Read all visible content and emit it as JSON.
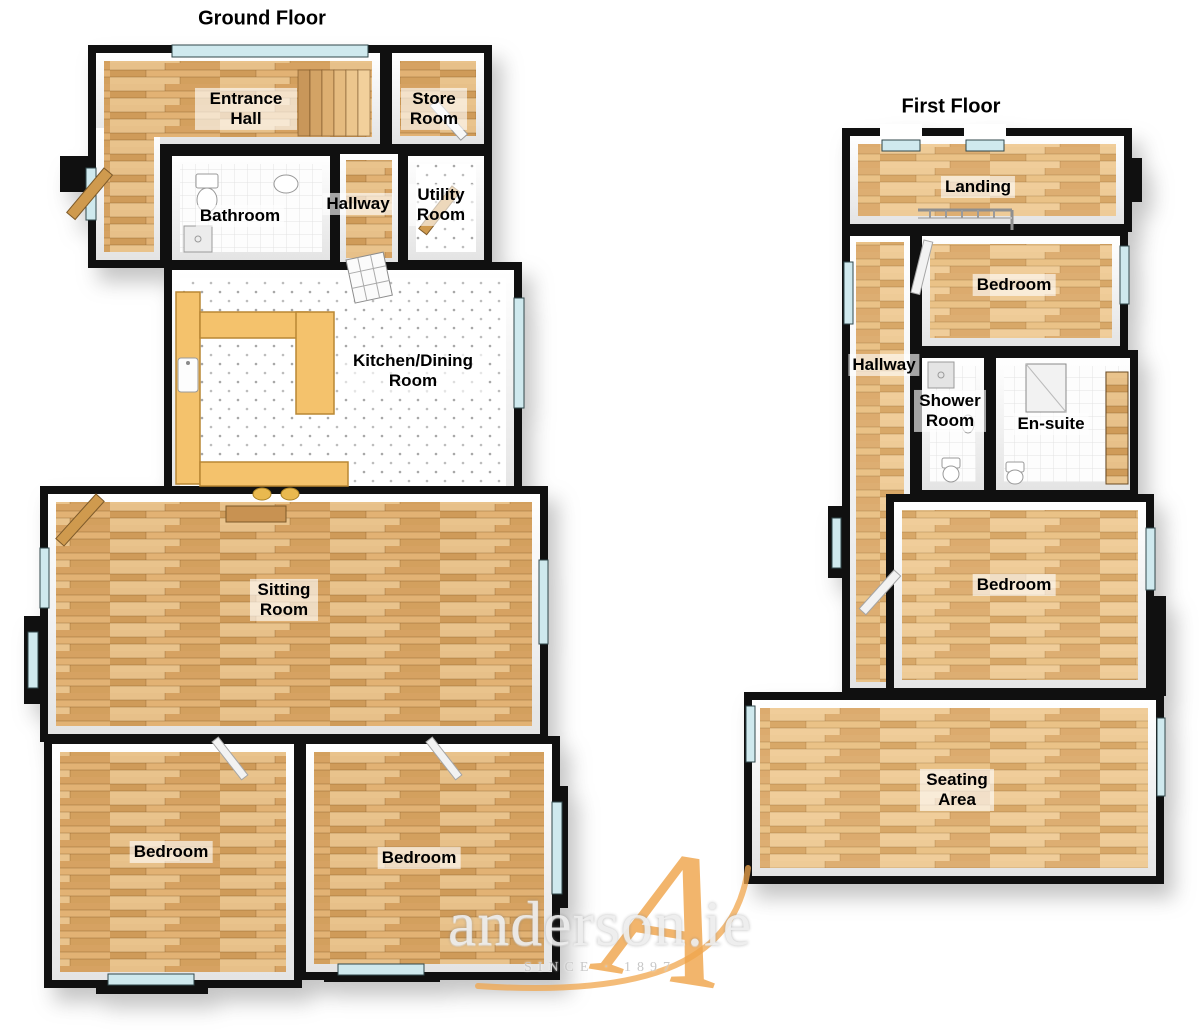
{
  "floors": {
    "ground": {
      "title": "Ground Floor",
      "rooms": {
        "entrance_hall": "Entrance Hall",
        "store_room": "Store Room",
        "bathroom": "Bathroom",
        "hallway": "Hallway",
        "utility_room": "Utility Room",
        "kitchen_dining": "Kitchen/Dining Room",
        "sitting_room": "Sitting Room",
        "bedroom_left": "Bedroom",
        "bedroom_right": "Bedroom"
      }
    },
    "first": {
      "title": "First Floor",
      "rooms": {
        "landing": "Landing",
        "hallway": "Hallway",
        "bedroom_top": "Bedroom",
        "shower_room": "Shower Room",
        "en_suite": "En-suite",
        "bedroom_middle": "Bedroom",
        "seating_area": "Seating Area"
      }
    }
  },
  "watermark": {
    "brand": "anderson.ie",
    "tagline": "SINCE · 1897",
    "monogram": "A",
    "accent_color": "#f0a64c",
    "text_color": "#ededed"
  },
  "colors": {
    "wall": "#101010",
    "wood_floor": "#dcaa6c",
    "wood_floor_light": "#e4ba80",
    "tile_white": "#fdfdfd",
    "window_glass": "#cfe9ee",
    "kitchen_counter": "#f4c26c",
    "label_background": "rgba(255,255,255,0.62)"
  }
}
